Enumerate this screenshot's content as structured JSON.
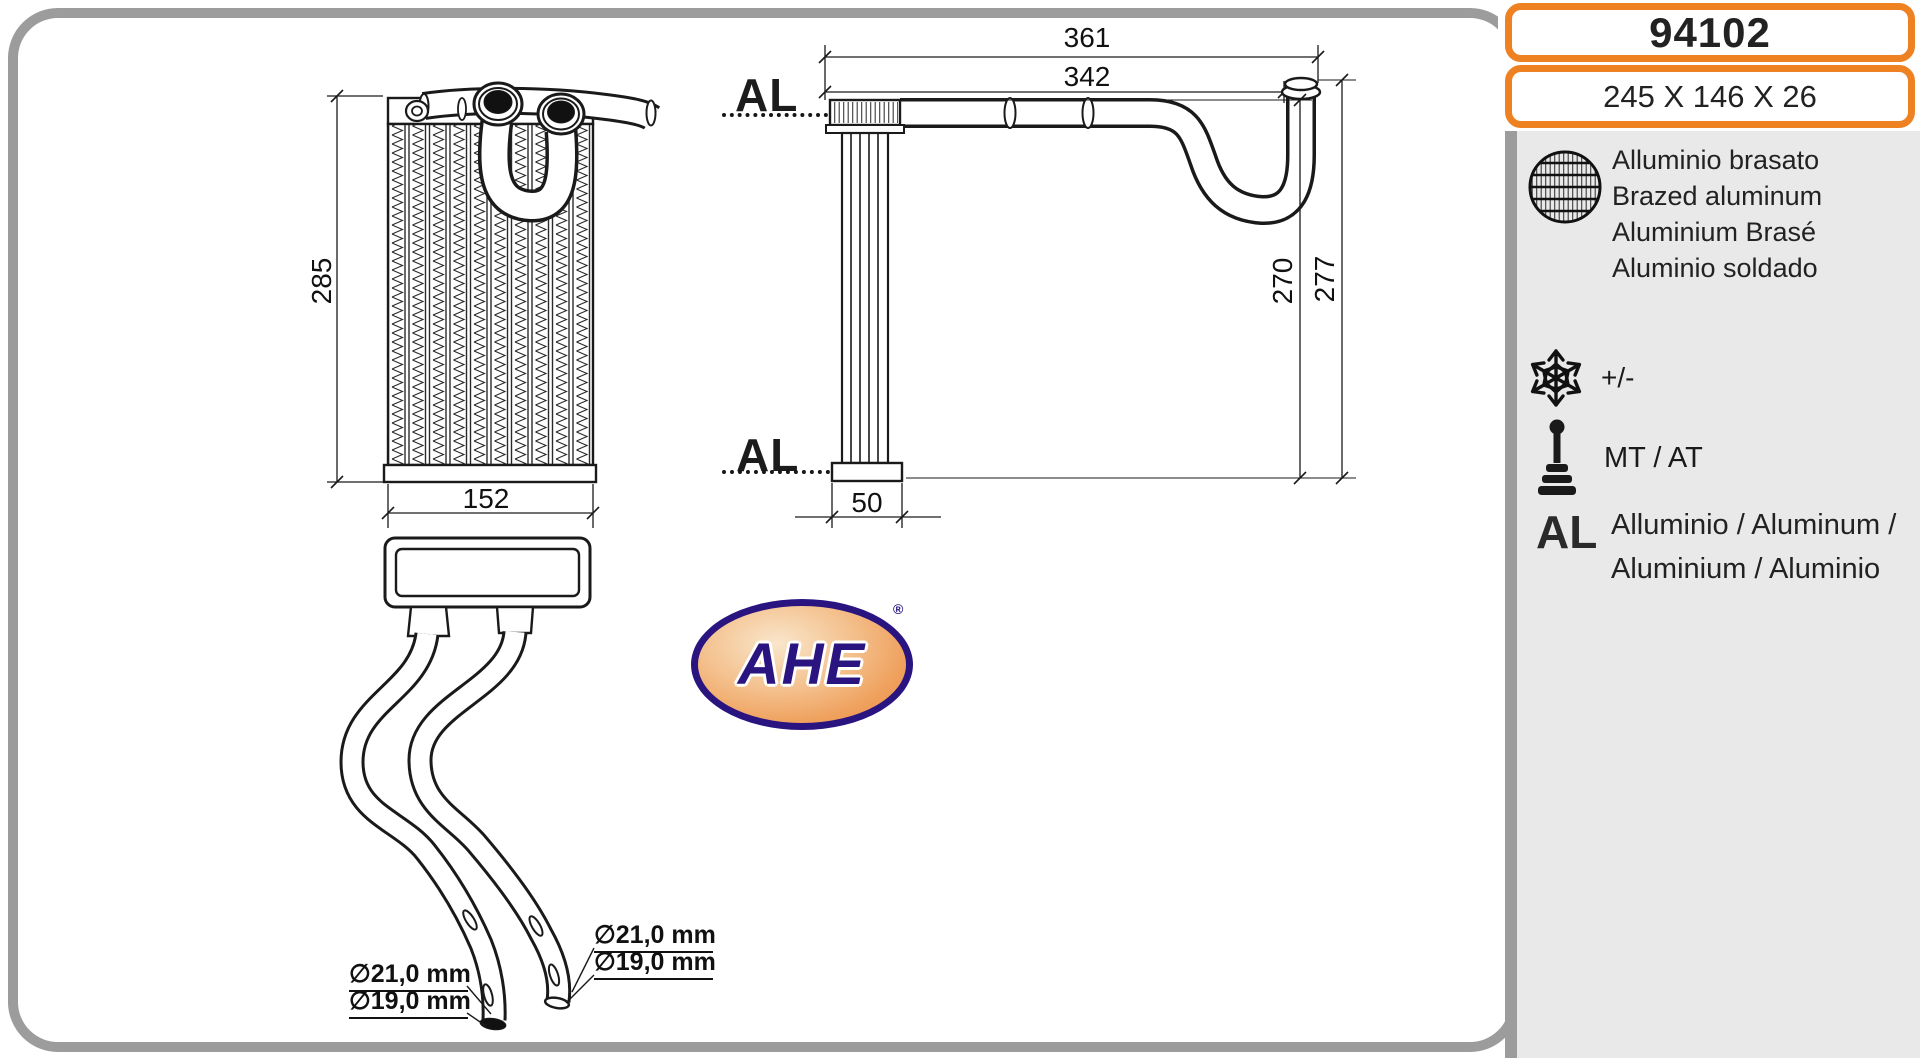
{
  "part": {
    "number": "94102",
    "size": "245 X 146 X 26"
  },
  "sidebar": {
    "material_lines": [
      "Alluminio brasato",
      "Brazed aluminum",
      "Aluminium Brasé",
      "Aluminio soldado"
    ],
    "temp_label": "+/-",
    "transmission_label": "MT / AT",
    "al_abbr": "AL",
    "al_line1": "Alluminio  / Aluminum /",
    "al_line2": "Aluminium / Aluminio",
    "icons": {
      "material_icon": "brazed-core-pattern",
      "temperature_icon": "snowflake",
      "transmission_icon": "gear-shift-lever"
    }
  },
  "views": {
    "front": {
      "dim_height": "285",
      "dim_width": "152"
    },
    "side": {
      "al_top": "AL",
      "al_bottom": "AL",
      "dim_total_width": "361",
      "dim_pipe_width": "342",
      "dim_core_height": "270",
      "dim_total_height": "277",
      "dim_flange": "50"
    }
  },
  "pipes": {
    "left_d1": "∅21,0 mm",
    "left_d2": "∅19,0 mm",
    "right_d1": "∅21,0 mm",
    "right_d2": "∅19,0 mm"
  },
  "logo": {
    "text": "AHE",
    "registered": "®"
  },
  "colors": {
    "accent_orange": "#ee8122",
    "border_gray": "#9c9c9c",
    "panel_gray": "#e9e9e9",
    "logo_navy": "#2a1580",
    "line_black": "#1a1a1a"
  }
}
